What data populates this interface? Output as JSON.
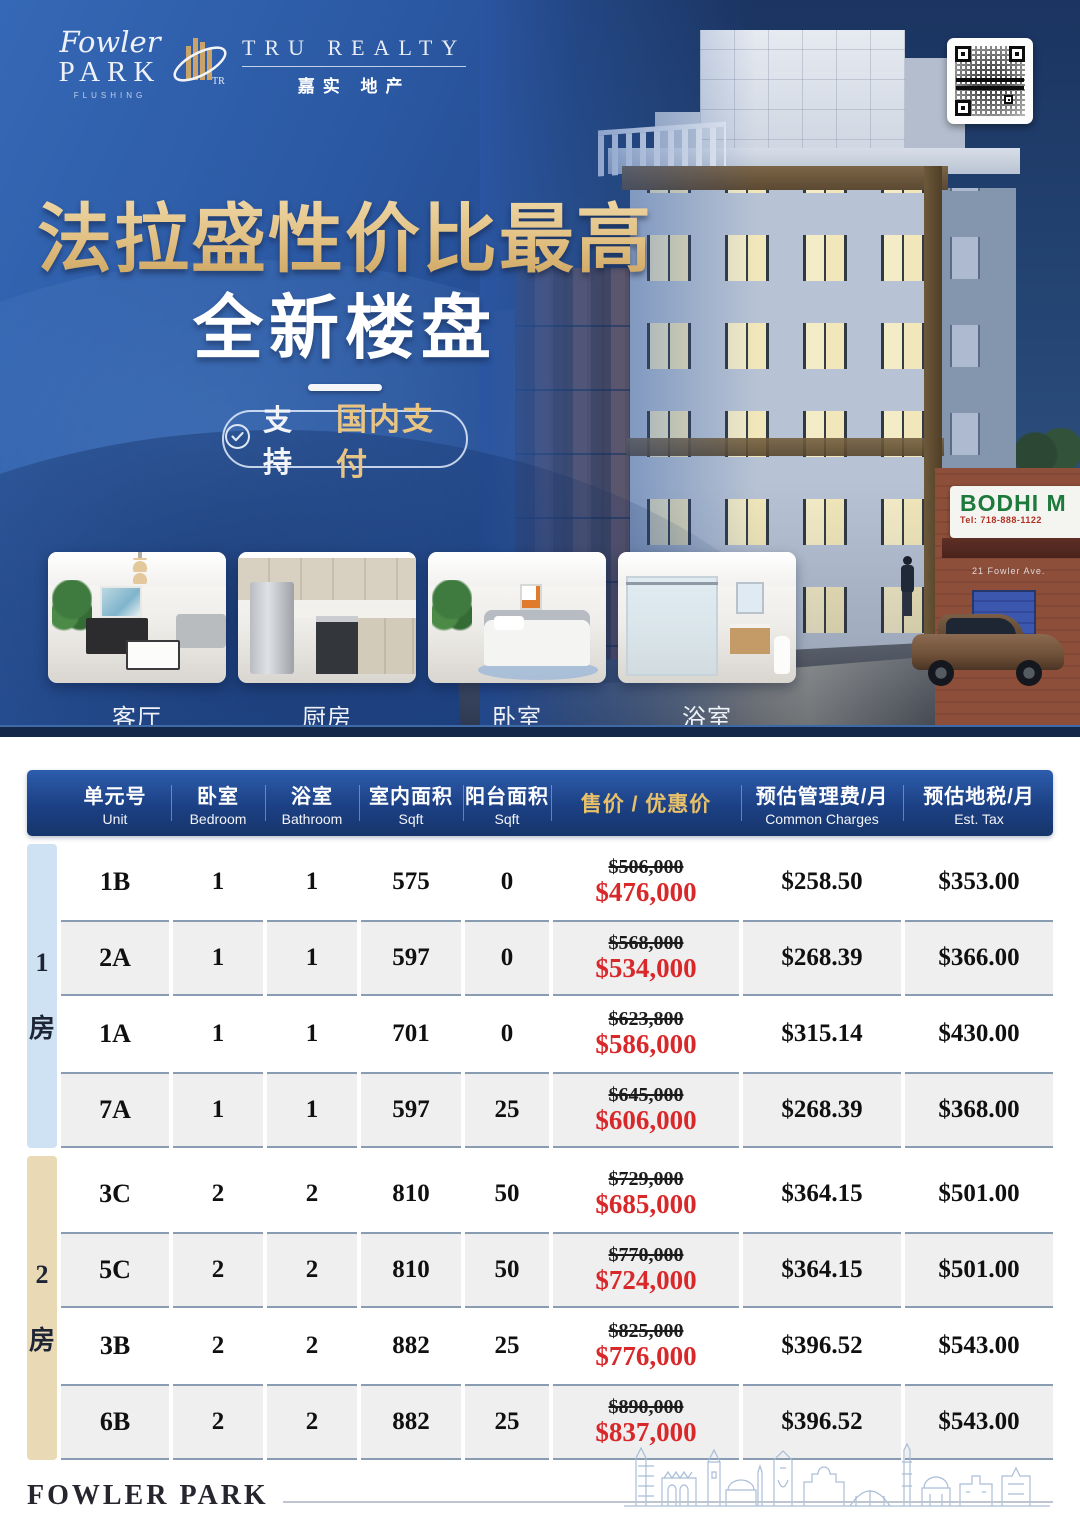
{
  "brand": {
    "fowler_script": "Fowler",
    "fowler_park": "PARK",
    "fowler_sub": "FLUSHING",
    "tru_name": "TRU REALTY",
    "tru_cn": "嘉实 地产"
  },
  "hero": {
    "headline_line1": "法拉盛性价比最高",
    "headline_line2": "全新楼盘",
    "badge_prefix": "支持",
    "badge_highlight": "国内支付",
    "scene_sign": "BODHI M",
    "scene_sign_tel": "Tel: 718-888-1122",
    "scene_address": "21 Fowler Ave."
  },
  "photos": [
    {
      "label": "客厅"
    },
    {
      "label": "厨房"
    },
    {
      "label": "卧室"
    },
    {
      "label": "浴室"
    }
  ],
  "table": {
    "headers": [
      {
        "cn": "单元号",
        "en": "Unit"
      },
      {
        "cn": "卧室",
        "en": "Bedroom"
      },
      {
        "cn": "浴室",
        "en": "Bathroom"
      },
      {
        "cn": "室内面积",
        "en": "Sqft"
      },
      {
        "cn": "阳台面积",
        "en": "Sqft"
      },
      {
        "cn": "售价 / 优惠价",
        "en": ""
      },
      {
        "cn": "预估管理费/月",
        "en": "Common Charges"
      },
      {
        "cn": "预估地税/月",
        "en": "Est. Tax"
      }
    ],
    "groups": [
      {
        "label_num": "1",
        "label_cn": "房",
        "rows": [
          {
            "unit": "1B",
            "bed": "1",
            "bath": "1",
            "sqft": "575",
            "balcony": "0",
            "price_orig": "$506,000",
            "price_sale": "$476,000",
            "common": "$258.50",
            "tax": "$353.00"
          },
          {
            "unit": "2A",
            "bed": "1",
            "bath": "1",
            "sqft": "597",
            "balcony": "0",
            "price_orig": "$568,000",
            "price_sale": "$534,000",
            "common": "$268.39",
            "tax": "$366.00"
          },
          {
            "unit": "1A",
            "bed": "1",
            "bath": "1",
            "sqft": "701",
            "balcony": "0",
            "price_orig": "$623,800",
            "price_sale": "$586,000",
            "common": "$315.14",
            "tax": "$430.00"
          },
          {
            "unit": "7A",
            "bed": "1",
            "bath": "1",
            "sqft": "597",
            "balcony": "25",
            "price_orig": "$645,000",
            "price_sale": "$606,000",
            "common": "$268.39",
            "tax": "$368.00"
          }
        ]
      },
      {
        "label_num": "2",
        "label_cn": "房",
        "rows": [
          {
            "unit": "3C",
            "bed": "2",
            "bath": "2",
            "sqft": "810",
            "balcony": "50",
            "price_orig": "$729,000",
            "price_sale": "$685,000",
            "common": "$364.15",
            "tax": "$501.00"
          },
          {
            "unit": "5C",
            "bed": "2",
            "bath": "2",
            "sqft": "810",
            "balcony": "50",
            "price_orig": "$770,000",
            "price_sale": "$724,000",
            "common": "$364.15",
            "tax": "$501.00"
          },
          {
            "unit": "3B",
            "bed": "2",
            "bath": "2",
            "sqft": "882",
            "balcony": "25",
            "price_orig": "$825,000",
            "price_sale": "$776,000",
            "common": "$396.52",
            "tax": "$543.00"
          },
          {
            "unit": "6B",
            "bed": "2",
            "bath": "2",
            "sqft": "882",
            "balcony": "25",
            "price_orig": "$890,000",
            "price_sale": "$837,000",
            "common": "$396.52",
            "tax": "$543.00"
          }
        ]
      }
    ]
  },
  "footer": {
    "brand": "FOWLER PARK"
  },
  "colors": {
    "accent_gold": "#e2c184",
    "price_red": "#d9282a",
    "header_blue": "#1c4084",
    "group1_band": "#cfe2f4",
    "group2_band": "#ead9b5"
  }
}
